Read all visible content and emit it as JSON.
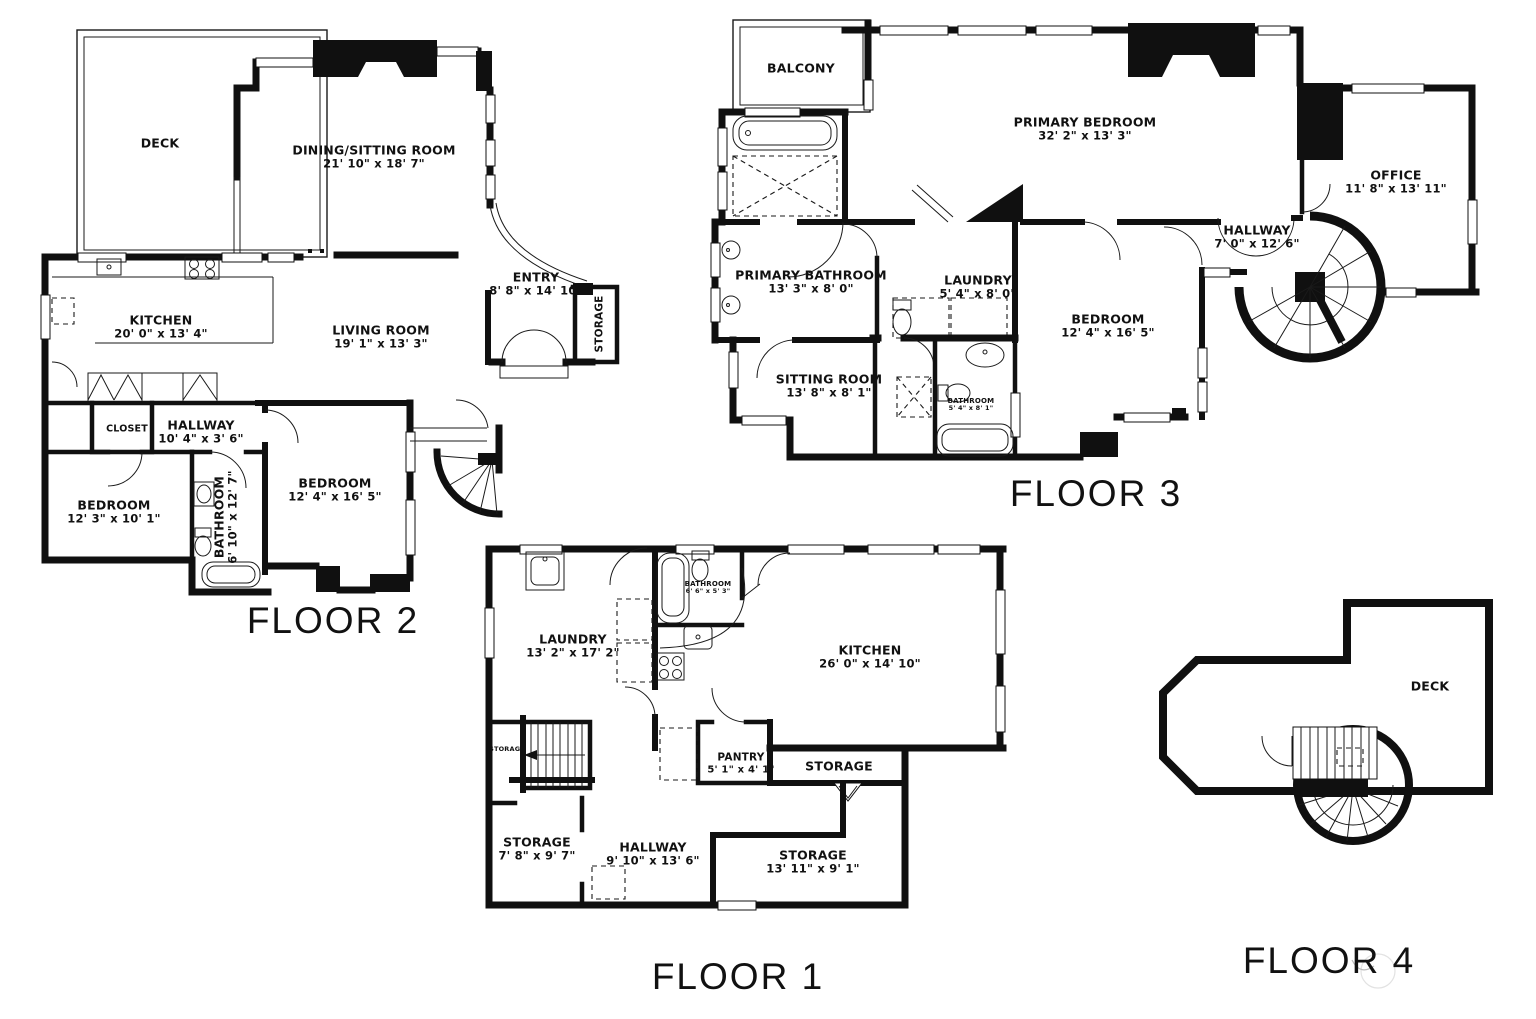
{
  "floors": [
    {
      "title": "FLOOR 2",
      "rooms": [
        {
          "name": "DECK",
          "dims": ""
        },
        {
          "name": "DINING/SITTING ROOM",
          "dims": "21' 10\" x 18' 7\""
        },
        {
          "name": "ENTRY",
          "dims": "8' 8\" x 14' 10\""
        },
        {
          "name": "STORAGE",
          "dims": ""
        },
        {
          "name": "KITCHEN",
          "dims": "20' 0\" x 13' 4\""
        },
        {
          "name": "LIVING ROOM",
          "dims": "19' 1\" x 13' 3\""
        },
        {
          "name": "CLOSET",
          "dims": ""
        },
        {
          "name": "HALLWAY",
          "dims": "10' 4\" x 3' 6\""
        },
        {
          "name": "BEDROOM",
          "dims": "12' 3\" x 10' 1\""
        },
        {
          "name": "BATHROOM",
          "dims": "6' 10\" x 12' 7\""
        },
        {
          "name": "BEDROOM",
          "dims": "12' 4\" x 16' 5\""
        }
      ]
    },
    {
      "title": "FLOOR 3",
      "rooms": [
        {
          "name": "BALCONY",
          "dims": ""
        },
        {
          "name": "PRIMARY BEDROOM",
          "dims": "32' 2\" x 13' 3\""
        },
        {
          "name": "OFFICE",
          "dims": "11' 8\" x 13' 11\""
        },
        {
          "name": "HALLWAY",
          "dims": "7' 0\" x 12' 6\""
        },
        {
          "name": "PRIMARY BATHROOM",
          "dims": "13' 3\" x 8' 0\""
        },
        {
          "name": "LAUNDRY",
          "dims": "5' 4\" x 8' 0\""
        },
        {
          "name": "BEDROOM",
          "dims": "12' 4\" x 16' 5\""
        },
        {
          "name": "SITTING ROOM",
          "dims": "13' 8\" x 8' 1\""
        },
        {
          "name": "BATHROOM",
          "dims": "5' 4\" x 8' 1\""
        }
      ]
    },
    {
      "title": "FLOOR 1",
      "rooms": [
        {
          "name": "LAUNDRY",
          "dims": "13' 2\" x 17' 2\""
        },
        {
          "name": "BATHROOM",
          "dims": "6' 6\" x 5' 3\""
        },
        {
          "name": "KITCHEN",
          "dims": "26' 0\" x 14' 10\""
        },
        {
          "name": "PANTRY",
          "dims": "5' 1\" x 4' 1\""
        },
        {
          "name": "STORAGE",
          "dims": ""
        },
        {
          "name": "STORAGE",
          "dims": ""
        },
        {
          "name": "STORAGE",
          "dims": "7' 8\" x 9' 7\""
        },
        {
          "name": "HALLWAY",
          "dims": "9' 10\" x 13' 6\""
        },
        {
          "name": "STORAGE",
          "dims": "13' 11\" x 9' 1\""
        }
      ]
    },
    {
      "title": "FLOOR 4",
      "rooms": [
        {
          "name": "DECK",
          "dims": ""
        }
      ]
    }
  ]
}
